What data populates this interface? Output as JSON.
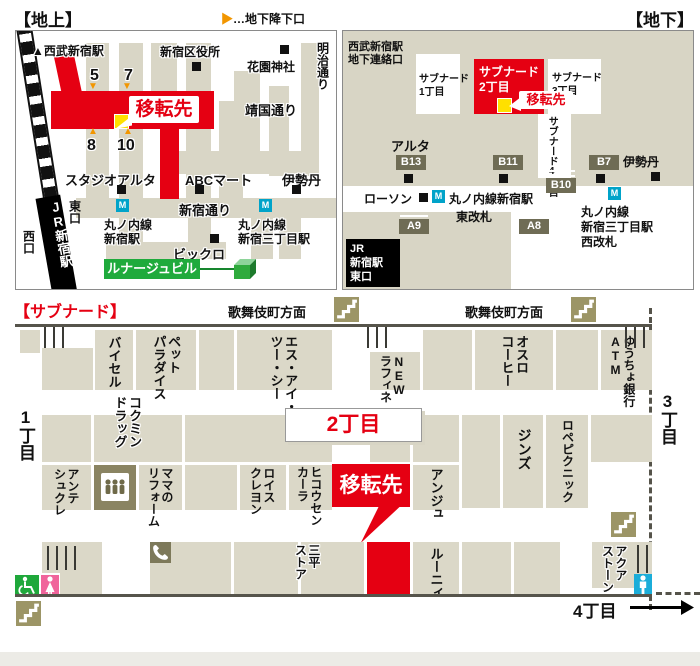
{
  "colors": {
    "accent_red": "#e50012",
    "street_beige": "#d9d6c6",
    "olive_badge": "#6f6c55",
    "stairs_olive": "#9c9566",
    "metro_blue": "#00a3c9",
    "marker_yellow": "#ffe000",
    "wheelchair_green": "#1fa83b",
    "women_pink": "#f0649b",
    "men_blue": "#1badd9",
    "lunage_green": "#1faa3c",
    "arrow_orange": "#f29600"
  },
  "ground": {
    "title": "【地上】",
    "legend": {
      "arrow": "▶",
      "text": "…地下降下口"
    },
    "arrow_down": "▼",
    "arrow_up": "▲",
    "metro_m": "M",
    "labels": {
      "seibu": "▲西武新宿駅",
      "ward_office": "新宿区役所",
      "hanazono": "花園神社",
      "meiji_dori": "明治通り",
      "yasukuni_dori": "靖国通り",
      "iten": "移転先",
      "exit5": "5",
      "exit7": "7",
      "exit8": "8",
      "exit10": "10",
      "studio_alta": "スタジオアルタ",
      "abc_mart": "ABCマート",
      "isetan": "伊勢丹",
      "shinjuku_dori": "新宿通り",
      "marunouchi_shinjuku": "丸ノ内線\n新宿駅",
      "marunouchi_sanchome": "丸ノ内線\n新宿三丁目駅",
      "bicqlo": "ビックロ",
      "lunage": "ルナージュビル",
      "jr_shinjuku": "JR新宿駅",
      "east_exit": "東口",
      "west_exit": "西口"
    }
  },
  "underground": {
    "title": "【地下】",
    "metro_m": "M",
    "labels": {
      "seibu_gate": "西武新宿駅\n地下連絡口",
      "subnade1": "サブナード\n1丁目",
      "subnade2": "サブナード\n2丁目",
      "subnade3": "サブナード\n3丁目",
      "subnade4": "サブナード4丁目",
      "iten": "移転先",
      "alta": "アルタ",
      "isetan": "伊勢丹",
      "lawson": "ローソン",
      "marunouchi_shinjuku": "丸ノ内線新宿駅",
      "higashi_gate": "東改札",
      "marunouchi_sanchome": "丸ノ内線\n新宿三丁目駅\n西改札",
      "jr_east": "JR\n新宿駅\n東口"
    },
    "badges": {
      "b13": "B13",
      "b11": "B11",
      "b7": "B7",
      "b10": "B10",
      "a9": "A9",
      "a8": "A8"
    }
  },
  "subnade": {
    "title": "【サブナード】",
    "kabukicho": "歌舞伎町方面",
    "chome1": "1丁目",
    "chome2": "2丁目",
    "chome3": "3丁目",
    "chome4": "4丁目",
    "iten": "移転先",
    "shops": {
      "baisel": "バイセル",
      "pet_paradise": "ペット\nパラダイス",
      "sic": "エス・アイ・\nツー・シー",
      "new_raffine": "NEW\nラフィネ",
      "oslo": "オスロ\nコーヒー",
      "yucho": "ゆうちょ銀行\nATM",
      "kokumin": "コクミン\nドラッグ",
      "ante": "アンテ\nシュクレ",
      "mama": "ママの\nリフォーム",
      "lois": "ロイス\nクレヨン",
      "hikosen": "ヒコウセン\nカーラ",
      "anju": "アンジュ",
      "jins": "ジンズ",
      "rope": "ロペピクニック",
      "sanpei": "三平\nストア",
      "lounie": "ルーニィ",
      "aqua": "アクア\nストーン"
    }
  }
}
